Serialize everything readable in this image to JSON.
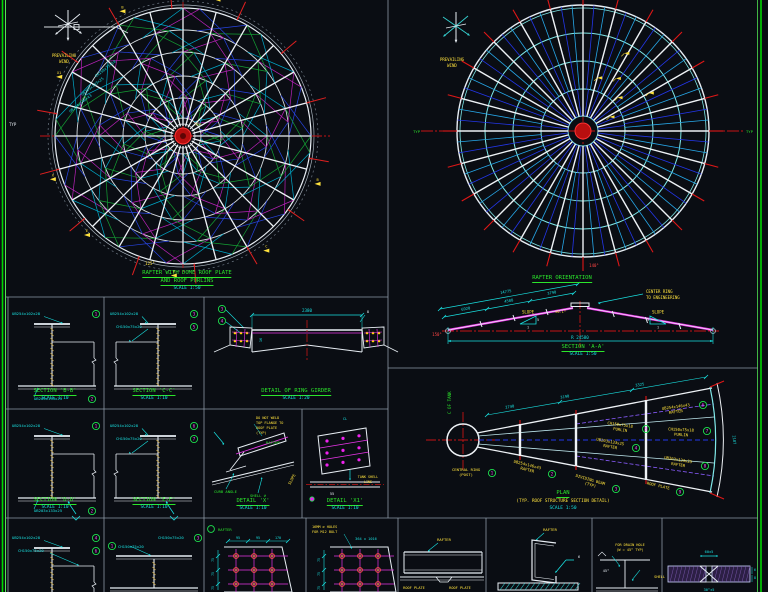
{
  "colors": {
    "background": "#0a0d13",
    "frame_green": "#00d400",
    "divider": "#8d99a6",
    "white": "#e8eef4",
    "cyan": "#19e0e0",
    "green": "#2be52b",
    "yellow": "#ffe23d",
    "red": "#e01717",
    "magenta": "#e935e9",
    "blue": "#2744e0",
    "sky": "#2fa7e8",
    "hatch": "#c8a23f"
  },
  "wind": {
    "line1": "PREVAILING",
    "line2": "WIND"
  },
  "dome_plan": {
    "title1": "RAFTER WITH DOME ROOF PLATE",
    "title2": "AND ROOF PURLINS",
    "scale": "SCALE 1:50",
    "typ_label": "TYP",
    "angle_label": "125°",
    "rim_labels": [
      "CH150x75x18",
      "UB203x133x25",
      "UB254x146x43"
    ],
    "flags": [
      "B",
      "C",
      "D",
      "E",
      "X",
      "X1",
      "B",
      "C"
    ]
  },
  "rafter_orientation": {
    "title": "RAFTER ORIENTATION",
    "angle_label": "140°",
    "note1": "CENTER RING",
    "note2": "TO ENGINEERING",
    "side_label_left": "TYP",
    "side_label_right": "TYP"
  },
  "section_aa": {
    "title": "SECTION 'A-A'",
    "scale": "SCALE 1:50",
    "dims_top": [
      "6920",
      "4588",
      "3790",
      "14775"
    ],
    "dim_bottom": "R 24580",
    "slope_label": "SLOPE",
    "slope_num": "1",
    "slope_den": "5",
    "angle_left": "150°",
    "ridge_note": "±0.1°"
  },
  "plan_cone": {
    "title": "PLAN",
    "subtitle": "(TYP. ROOF STRUCTURE SECTION DETAIL)",
    "scale": "SCALE 1:50",
    "axis_label": "C OF TANK",
    "labels": [
      {
        "text": "CENTRAL RING",
        "text2": "(POST)",
        "num": "1"
      },
      {
        "text": "UB254x146x43",
        "text2": "RAFTER",
        "num": "2"
      },
      {
        "text": "DIVIDING BEAM",
        "text2": "(TYP)",
        "num": "3"
      },
      {
        "text": "UB203x133x25",
        "text2": "RAFTER",
        "num": "4"
      },
      {
        "text": "CH150x75x18",
        "text2": "PURLIN",
        "num": "5"
      },
      {
        "text": "UB254x146x43",
        "text2": "RAFTER",
        "num": "6"
      },
      {
        "text": "CH150x75x18",
        "text2": "PURLIN",
        "num": "7"
      },
      {
        "text": "UB203x133x25",
        "text2": "RAFTER",
        "num": "8"
      },
      {
        "text": "ROOF PLATE",
        "text2": "",
        "num": "9"
      }
    ],
    "dims": [
      "2740",
      "3190",
      "3325",
      "2187"
    ]
  },
  "section_bb": {
    "title": "SECTION 'B-B'",
    "scale": "SCALE 1:10",
    "labels": [
      {
        "text": "UB254x102x28",
        "num": "1"
      },
      {
        "text": "UB203x133x25",
        "num": "2"
      }
    ]
  },
  "section_cc": {
    "title": "SECTION 'C-C'",
    "scale": "SCALE 1:10",
    "labels": [
      {
        "text": "UB254x102x28",
        "num": "3"
      },
      {
        "text": "CH150x75x20",
        "num": "5"
      }
    ]
  },
  "ring_girder": {
    "title": "DETAIL OF RING GIRDER",
    "scale": "SCALE 1:20",
    "dim_top": "2380",
    "dim_web": "16",
    "marker1": "3",
    "marker2": "4",
    "weld": "8"
  },
  "section_dd": {
    "title": "SECTION 'D-D'",
    "scale": "SCALE 1:10",
    "labels": [
      {
        "text": "UB254x102x28",
        "num": "1"
      },
      {
        "text": "UB203x133x25",
        "num": "2"
      }
    ]
  },
  "section_ee": {
    "title": "SECTION 'E-E'",
    "scale": "SCALE 1:10",
    "labels": [
      {
        "text": "UB254x102x28",
        "num": "6"
      },
      {
        "text": "CH150x75x20",
        "num": "7"
      }
    ]
  },
  "detail_x": {
    "title": "DETAIL 'X'",
    "scale": "SCALE 1:10",
    "curb": "CURB ANGLE",
    "shell": "SHELL ⌀",
    "rafter": "RAFTER",
    "slope": "SLOPE",
    "note": [
      "DO NOT WELD",
      "TOP FLANGE TO",
      "ROOF PLATE",
      "(TYP)"
    ]
  },
  "detail_x1": {
    "title": "DETAIL 'X1'",
    "scale": "SCALE 1:10",
    "shell_line1": "TANK SHELL",
    "shell_line2": "LINE",
    "dim": "55",
    "cl": "CL"
  },
  "bottom": {
    "bs1_labels": [
      {
        "text": "UB254x102x28",
        "num": "4"
      },
      {
        "text": "CH150x75x20",
        "num": "6"
      }
    ],
    "bs2_labels": [
      {
        "text": "CH150x75x20",
        "num": "1"
      },
      {
        "text": "CH150x75x20",
        "num": "3"
      }
    ],
    "bp1": {
      "rafter": "RAFTER",
      "dims_top": [
        "95",
        "95",
        "170"
      ],
      "dims_left": [
        "75",
        "75",
        "75"
      ]
    },
    "bp2": {
      "note1": "16MM ⌀ HOLES",
      "note2": "FOR M12 BOLT",
      "dim_top": "364 x 1016",
      "dims_left": [
        "75",
        "75",
        "75"
      ]
    },
    "bd1": {
      "rafter": "RAFTER",
      "plate1": "ROOF PLATE",
      "plate2": "ROOF PLATE"
    },
    "bd2": {
      "rafter": "RAFTER",
      "plate": "ROOF PLATE",
      "weld": "6"
    },
    "bd3": {
      "note1": "FOR DRAIN HOLE",
      "note2": "(W = 45° TYP)",
      "angle": "45°"
    },
    "bd4": {
      "dim_top": "60±5",
      "dim_bottom": "30°±5",
      "label": "SHELL",
      "t1": "6",
      "t2": "8"
    }
  }
}
